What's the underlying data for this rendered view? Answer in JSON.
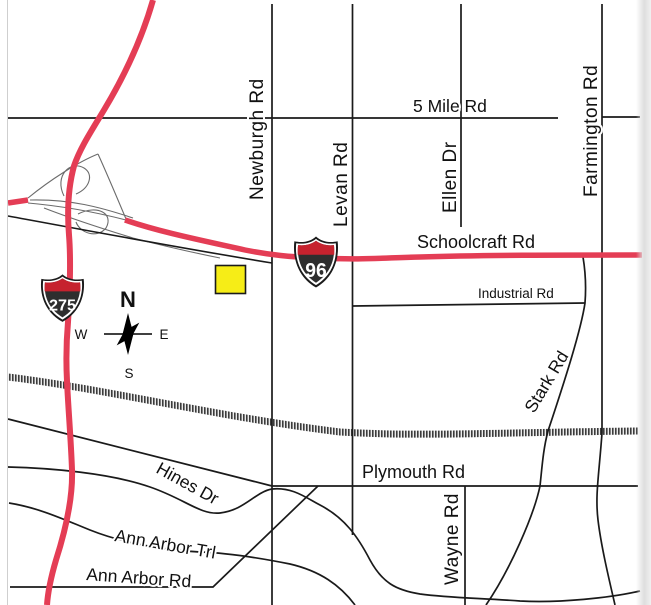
{
  "map": {
    "marker": {
      "shape": "yellow-square-highlight"
    },
    "highway_shields": [
      {
        "system": "interstate",
        "number": "275"
      },
      {
        "system": "interstate",
        "number": "96"
      }
    ],
    "compass": {
      "north": "N",
      "south": "S",
      "east": "E",
      "west": "W"
    },
    "road_labels": {
      "five_mile": "5 Mile Rd",
      "newburgh": "Newburgh Rd",
      "levan": "Levan Rd",
      "ellen": "Ellen Dr",
      "farmington": "Farmington Rd",
      "schoolcraft": "Schoolcraft Rd",
      "industrial": "Industrial Rd",
      "stark": "Stark Rd",
      "plymouth": "Plymouth Rd",
      "wayne": "Wayne Rd",
      "hines": "Hines Dr",
      "ann_arbor_trl": "Ann Arbor Trl",
      "ann_arbor_rd": "Ann Arbor Rd"
    },
    "colors": {
      "highway": "#e43d55",
      "shield_red": "#c6222e",
      "shield_body": "#2e2e2e",
      "marker": "#f6ed17",
      "road": "#1a1a1a",
      "railroad_tick": "#3c3c3c"
    }
  }
}
